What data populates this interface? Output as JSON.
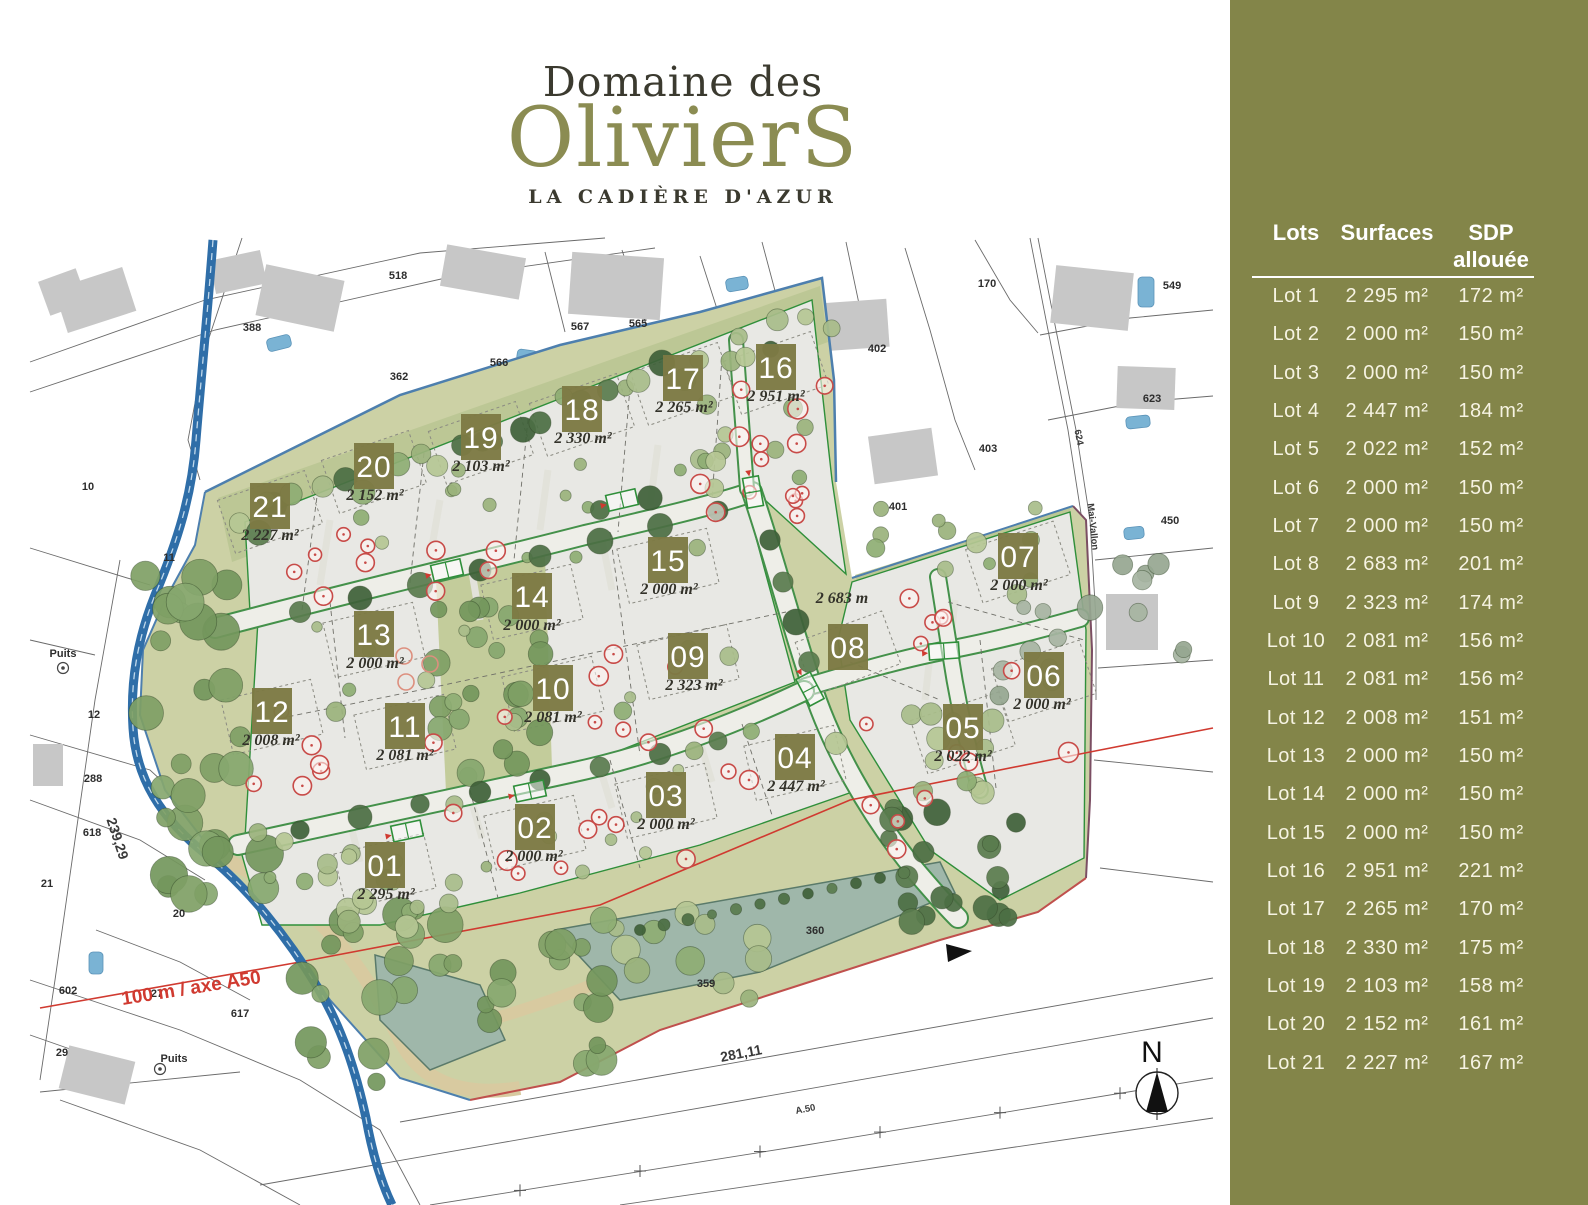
{
  "title": {
    "line1": "Domaine des",
    "line2": "OlivierS",
    "line3": "LA CADIÈRE D'AZUR"
  },
  "sidebar": {
    "header": {
      "lots": "Lots",
      "surfaces": "Surfaces",
      "sdp_line1": "SDP",
      "sdp_line2": "allouée"
    },
    "rows": [
      {
        "lot": "Lot 1",
        "surface": "2 295 m²",
        "sdp": "172 m²"
      },
      {
        "lot": "Lot 2",
        "surface": "2 000 m²",
        "sdp": "150 m²"
      },
      {
        "lot": "Lot 3",
        "surface": "2 000 m²",
        "sdp": "150 m²"
      },
      {
        "lot": "Lot 4",
        "surface": "2 447 m²",
        "sdp": "184 m²"
      },
      {
        "lot": "Lot 5",
        "surface": "2 022 m²",
        "sdp": "152 m²"
      },
      {
        "lot": "Lot 6",
        "surface": "2 000 m²",
        "sdp": "150 m²"
      },
      {
        "lot": "Lot 7",
        "surface": "2 000 m²",
        "sdp": "150 m²"
      },
      {
        "lot": "Lot 8",
        "surface": "2 683 m²",
        "sdp": "201 m²"
      },
      {
        "lot": "Lot 9",
        "surface": "2 323 m²",
        "sdp": "174 m²"
      },
      {
        "lot": "Lot 10",
        "surface": "2 081 m²",
        "sdp": "156 m²"
      },
      {
        "lot": "Lot 11",
        "surface": "2 081 m²",
        "sdp": "156 m²"
      },
      {
        "lot": "Lot 12",
        "surface": "2 008 m²",
        "sdp": "151 m²"
      },
      {
        "lot": "Lot 13",
        "surface": "2 000 m²",
        "sdp": "150 m²"
      },
      {
        "lot": "Lot 14",
        "surface": "2 000 m²",
        "sdp": "150 m²"
      },
      {
        "lot": "Lot 15",
        "surface": "2 000 m²",
        "sdp": "150 m²"
      },
      {
        "lot": "Lot 16",
        "surface": "2 951 m²",
        "sdp": "221 m²"
      },
      {
        "lot": "Lot 17",
        "surface": "2 265 m²",
        "sdp": "170 m²"
      },
      {
        "lot": "Lot 18",
        "surface": "2 330 m²",
        "sdp": "175 m²"
      },
      {
        "lot": "Lot 19",
        "surface": "2 103 m²",
        "sdp": "158 m²"
      },
      {
        "lot": "Lot 20",
        "surface": "2 152 m²",
        "sdp": "161 m²"
      },
      {
        "lot": "Lot 21",
        "surface": "2 227 m²",
        "sdp": "167 m²"
      }
    ]
  },
  "map": {
    "badges": [
      {
        "num": "01",
        "area": "2 295 m²",
        "x": 385,
        "y": 865,
        "ax": 386,
        "ay": 899,
        "rot": -13
      },
      {
        "num": "02",
        "area": "2 000 m²",
        "x": 535,
        "y": 827,
        "ax": 534,
        "ay": 861,
        "rot": -13
      },
      {
        "num": "03",
        "area": "2 000 m²",
        "x": 666,
        "y": 795,
        "ax": 666,
        "ay": 829,
        "rot": -13
      },
      {
        "num": "04",
        "area": "2 447 m²",
        "x": 795,
        "y": 757,
        "ax": 796,
        "ay": 791,
        "rot": -13
      },
      {
        "num": "05",
        "area": "2 022 m²",
        "x": 963,
        "y": 727,
        "ax": 963,
        "ay": 761,
        "rot": -18
      },
      {
        "num": "06",
        "area": "2 000 m²",
        "x": 1044,
        "y": 675,
        "ax": 1042,
        "ay": 709,
        "rot": -18
      },
      {
        "num": "07",
        "area": "2 000 m²",
        "x": 1018,
        "y": 556,
        "ax": 1019,
        "ay": 590,
        "rot": -18
      },
      {
        "num": "08",
        "area": "2 683 m",
        "x": 848,
        "y": 647,
        "ax": 842,
        "ay": 603,
        "rot": -20
      },
      {
        "num": "09",
        "area": "2 323 m²",
        "x": 688,
        "y": 656,
        "ax": 694,
        "ay": 690,
        "rot": -13
      },
      {
        "num": "10",
        "area": "2 081 m²",
        "x": 553,
        "y": 688,
        "ax": 553,
        "ay": 722,
        "rot": -13
      },
      {
        "num": "11",
        "area": "2 081 m²",
        "x": 405,
        "y": 726,
        "ax": 405,
        "ay": 760,
        "rot": -13
      },
      {
        "num": "12",
        "area": "2 008 m²",
        "x": 272,
        "y": 711,
        "ax": 271,
        "ay": 745,
        "rot": -13
      },
      {
        "num": "13",
        "area": "2 000 m²",
        "x": 374,
        "y": 634,
        "ax": 375,
        "ay": 668,
        "rot": -13
      },
      {
        "num": "14",
        "area": "2 000 m²",
        "x": 532,
        "y": 596,
        "ax": 532,
        "ay": 630,
        "rot": -13
      },
      {
        "num": "15",
        "area": "2 000 m²",
        "x": 668,
        "y": 560,
        "ax": 669,
        "ay": 594,
        "rot": -13
      },
      {
        "num": "16",
        "area": "2 951 m²",
        "x": 776,
        "y": 367,
        "ax": 776,
        "ay": 401,
        "rot": -19
      },
      {
        "num": "17",
        "area": "2 265 m²",
        "x": 683,
        "y": 378,
        "ax": 684,
        "ay": 412,
        "rot": -19
      },
      {
        "num": "18",
        "area": "2 330 m²",
        "x": 582,
        "y": 409,
        "ax": 583,
        "ay": 443,
        "rot": -19
      },
      {
        "num": "19",
        "area": "2 103 m²",
        "x": 481,
        "y": 437,
        "ax": 481,
        "ay": 471,
        "rot": -19
      },
      {
        "num": "20",
        "area": "2 152 m²",
        "x": 374,
        "y": 466,
        "ax": 375,
        "ay": 500,
        "rot": -19
      },
      {
        "num": "21",
        "area": "2 227 m²",
        "x": 270,
        "y": 506,
        "ax": 270,
        "ay": 540,
        "rot": -19
      }
    ],
    "labels": [
      {
        "t": "518",
        "x": 398,
        "y": 279,
        "c": "p"
      },
      {
        "t": "566",
        "x": 499,
        "y": 366,
        "c": "p"
      },
      {
        "t": "362",
        "x": 399,
        "y": 380,
        "c": "p"
      },
      {
        "t": "567",
        "x": 580,
        "y": 330,
        "c": "p"
      },
      {
        "t": "565",
        "x": 638,
        "y": 327,
        "c": "p"
      },
      {
        "t": "402",
        "x": 877,
        "y": 352,
        "c": "p"
      },
      {
        "t": "170",
        "x": 987,
        "y": 287,
        "c": "p"
      },
      {
        "t": "549",
        "x": 1172,
        "y": 289,
        "c": "p"
      },
      {
        "t": "623",
        "x": 1152,
        "y": 402,
        "c": "p"
      },
      {
        "t": "403",
        "x": 988,
        "y": 452,
        "c": "p"
      },
      {
        "t": "401",
        "x": 898,
        "y": 510,
        "c": "p"
      },
      {
        "t": "450",
        "x": 1170,
        "y": 524,
        "c": "p"
      },
      {
        "t": "388",
        "x": 252,
        "y": 331,
        "c": "p"
      },
      {
        "t": "10",
        "x": 88,
        "y": 490,
        "c": "p"
      },
      {
        "t": "11",
        "x": 169,
        "y": 561,
        "c": "p"
      },
      {
        "t": "12",
        "x": 94,
        "y": 718,
        "c": "p"
      },
      {
        "t": "288",
        "x": 93,
        "y": 782,
        "c": "p"
      },
      {
        "t": "618",
        "x": 92,
        "y": 836,
        "c": "p"
      },
      {
        "t": "21",
        "x": 47,
        "y": 887,
        "c": "p"
      },
      {
        "t": "20",
        "x": 179,
        "y": 917,
        "c": "p"
      },
      {
        "t": "602",
        "x": 68,
        "y": 994,
        "c": "p"
      },
      {
        "t": "27",
        "x": 157,
        "y": 997,
        "c": "p"
      },
      {
        "t": "617",
        "x": 240,
        "y": 1017,
        "c": "p"
      },
      {
        "t": "29",
        "x": 62,
        "y": 1056,
        "c": "p"
      },
      {
        "t": "360",
        "x": 815,
        "y": 934,
        "c": "p"
      },
      {
        "t": "359",
        "x": 706,
        "y": 987,
        "c": "p"
      },
      {
        "t": "Puits",
        "x": 63,
        "y": 657,
        "c": "p"
      },
      {
        "t": "Puits",
        "x": 174,
        "y": 1062,
        "c": "p"
      },
      {
        "t": "624",
        "x": 1076,
        "y": 438,
        "c": "t",
        "r": 78
      },
      {
        "t": "Mai-Vallon",
        "x": 1090,
        "y": 527,
        "c": "t",
        "r": 84
      },
      {
        "t": "239,29",
        "x": 113,
        "y": 840,
        "c": "d",
        "r": 72
      },
      {
        "t": "281,11",
        "x": 742,
        "y": 1058,
        "c": "d",
        "r": -11
      },
      {
        "t": "A.50",
        "x": 806,
        "y": 1112,
        "c": "t",
        "r": -11
      },
      {
        "t": "100 m / axe A50",
        "x": 192,
        "y": 994,
        "c": "r",
        "r": -9
      },
      {
        "t": "N",
        "x": 1152,
        "y": 1062,
        "c": "n"
      }
    ]
  },
  "colors": {
    "sidebar_bg": "#838549",
    "badge": "#7d7a44",
    "accent_olive": "#8b8c52",
    "red_line": "#d03a30",
    "stream_blue": "#2f6ea8",
    "site_green": "#ccd1a5",
    "parcel_gray": "#e8e8e4",
    "boundary_green": "#2f8f3a"
  }
}
